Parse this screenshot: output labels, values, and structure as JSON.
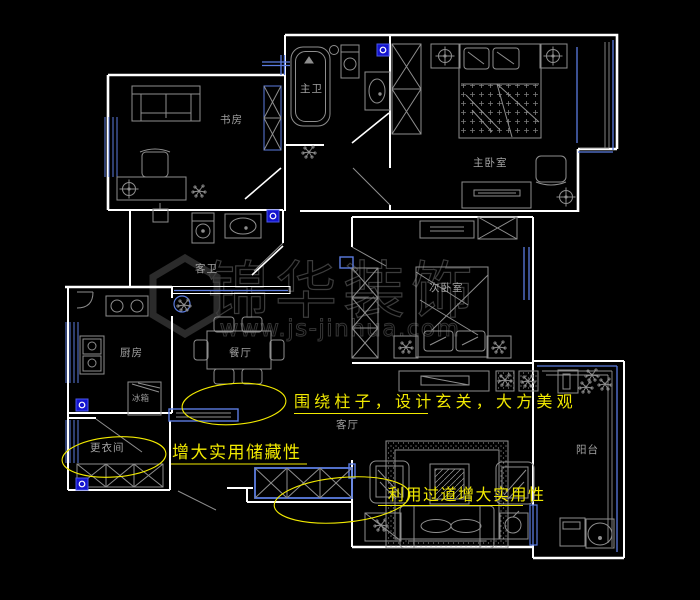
{
  "colors": {
    "background": "#000000",
    "wall_white": "#ffffff",
    "furniture_gray": "#8e8e8e",
    "window_blue": "#5b7ce0",
    "marker_blue": "#1414cf",
    "annotation_yellow": "#f2ea00",
    "room_label_gray": "#a2a2a2",
    "watermark_gray": "#3c3c3c"
  },
  "rooms": {
    "study": {
      "label": "书房"
    },
    "master_bath": {
      "label": "主卫"
    },
    "master_bedroom": {
      "label": "主卧室"
    },
    "guest_bath": {
      "label": "客卫"
    },
    "kitchen": {
      "label": "厨房"
    },
    "fridge": {
      "label": "冰箱"
    },
    "dining": {
      "label": "餐厅"
    },
    "second_bedroom": {
      "label": "次卧室"
    },
    "living": {
      "label": "客厅"
    },
    "balcony": {
      "label": "阳台"
    },
    "dressing": {
      "label": "更衣间"
    }
  },
  "annotations": [
    {
      "text": "围绕柱子，设计玄关，大方美观",
      "style": "yellow underlined callout"
    },
    {
      "text": "增大实用储藏性",
      "style": "yellow underlined callout with ellipse"
    },
    {
      "text": "利用过道增大实用性",
      "style": "yellow underlined callout with ellipse"
    }
  ],
  "watermark": {
    "brand": "锦华装饰",
    "website": "www.js-jinhua.com"
  }
}
